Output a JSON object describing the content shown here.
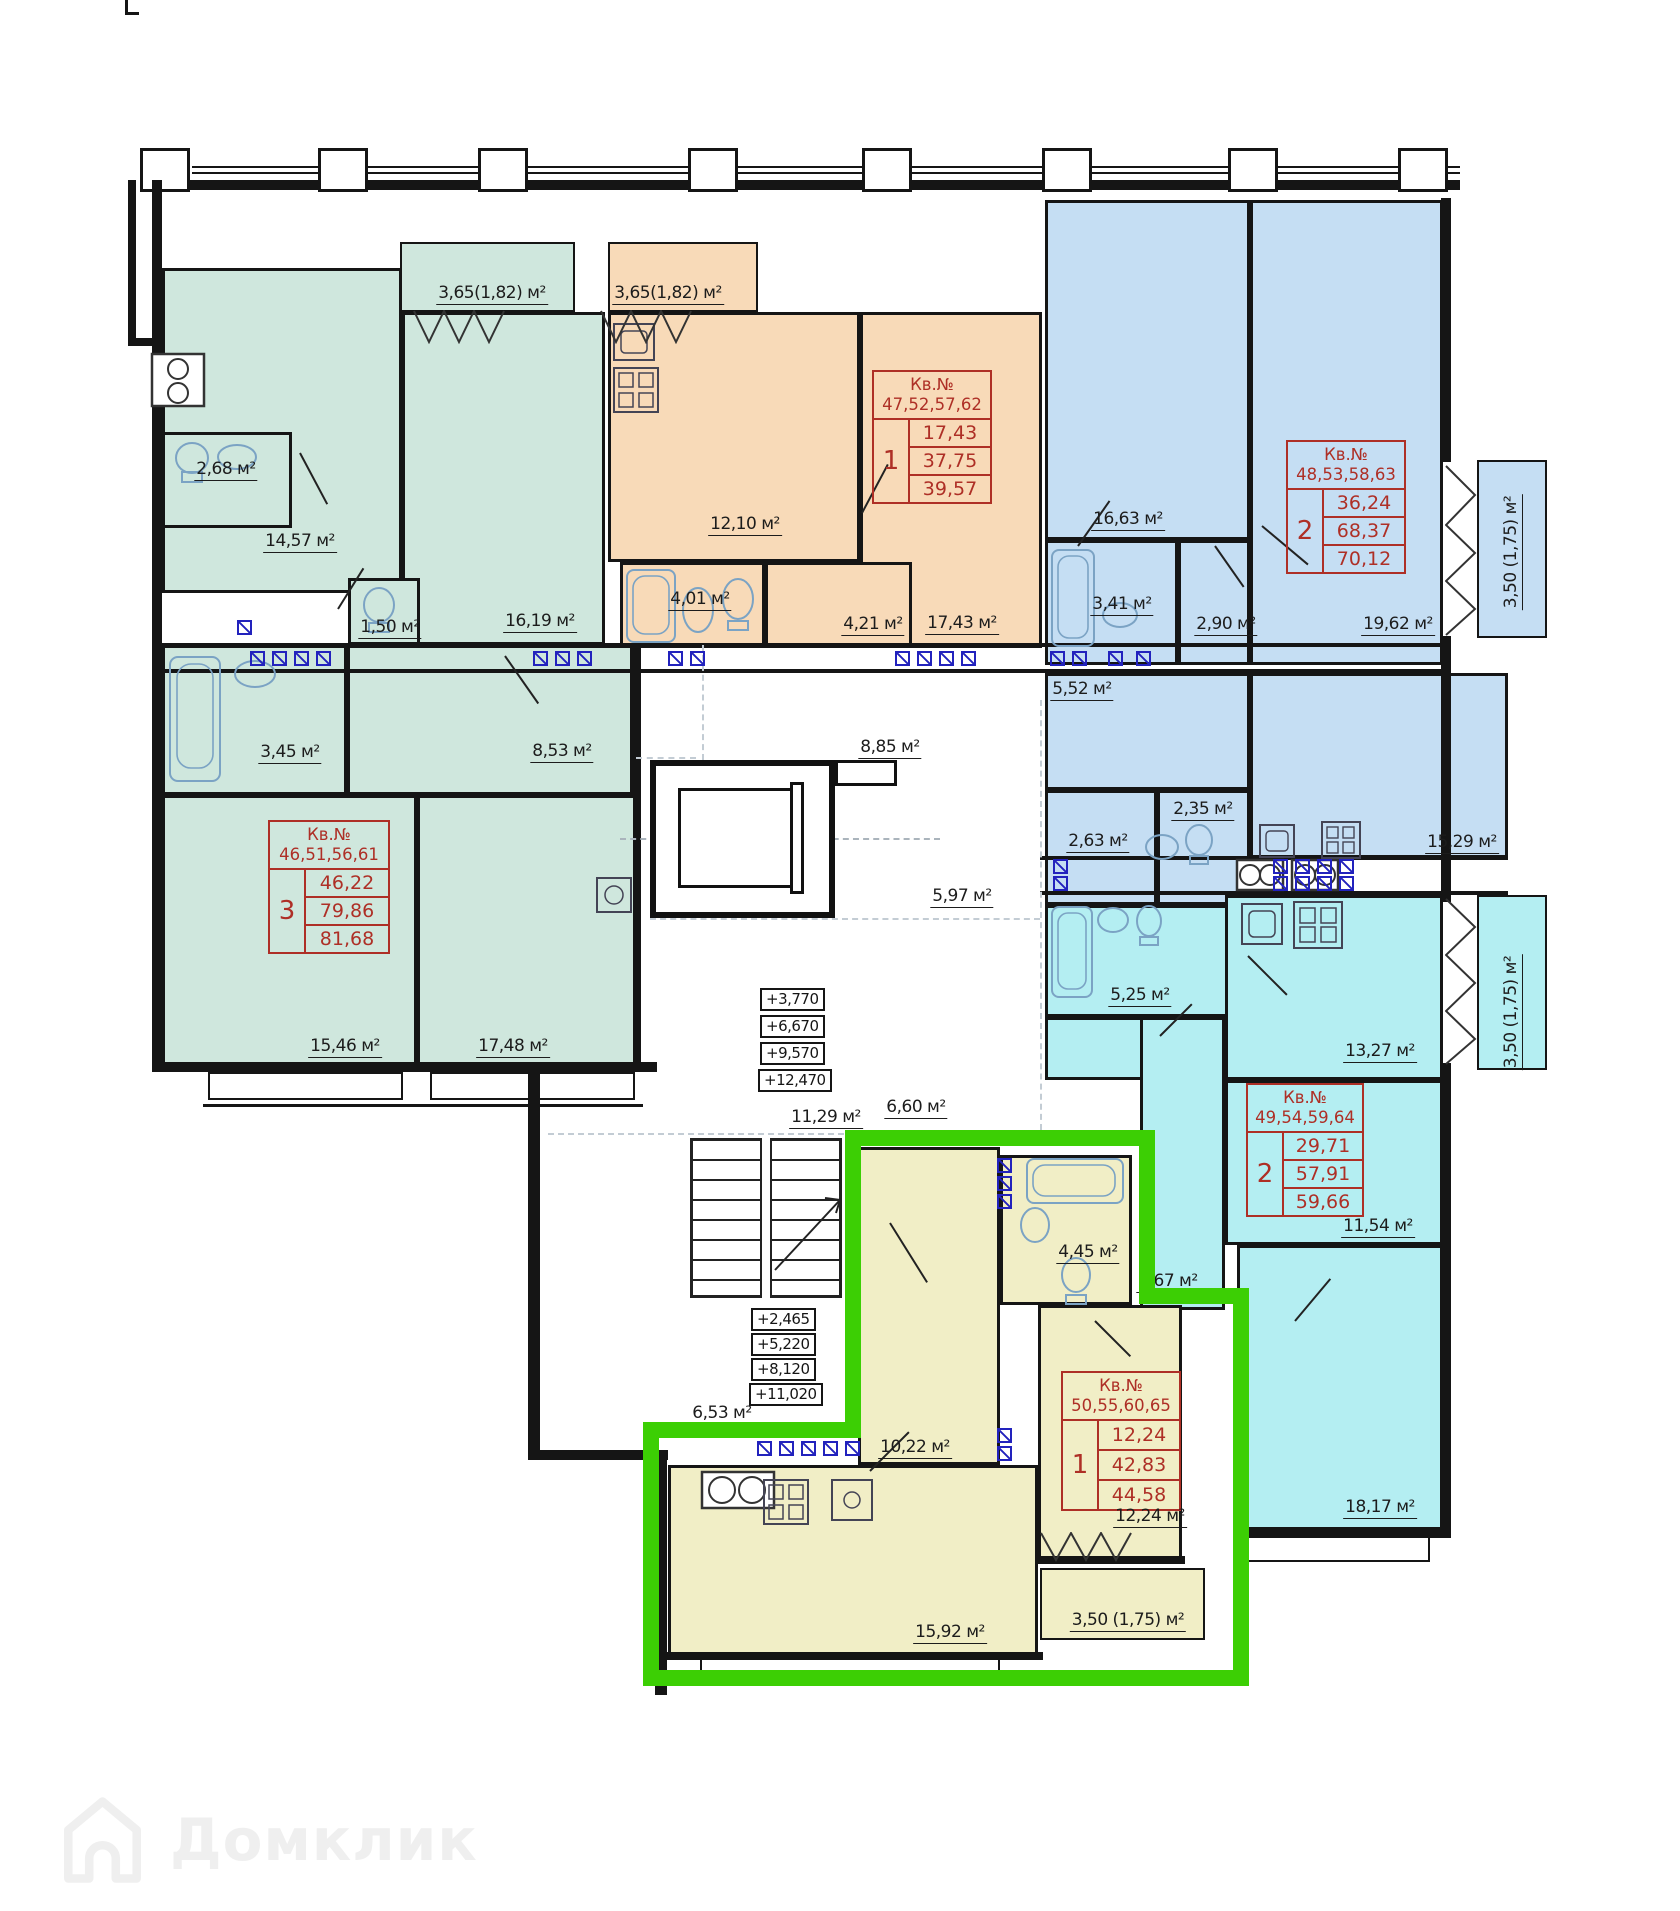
{
  "watermark": {
    "label": "Домклик",
    "icon": "domclick-house-icon"
  },
  "tables": {
    "green": {
      "kv": "Кв.№",
      "nums": "46,51,56,61",
      "rooms": "3",
      "v1": "46,22",
      "v2": "79,86",
      "v3": "81,68"
    },
    "orange": {
      "kv": "Кв.№",
      "nums": "47,52,57,62",
      "rooms": "1",
      "v1": "17,43",
      "v2": "37,75",
      "v3": "39,57"
    },
    "blue": {
      "kv": "Кв.№",
      "nums": "48,53,58,63",
      "rooms": "2",
      "v1": "36,24",
      "v2": "68,37",
      "v3": "70,12"
    },
    "cyan": {
      "kv": "Кв.№",
      "nums": "49,54,59,64",
      "rooms": "2",
      "v1": "29,71",
      "v2": "57,91",
      "v3": "59,66"
    },
    "yellow": {
      "kv": "Кв.№",
      "nums": "50,55,60,65",
      "rooms": "1",
      "v1": "12,24",
      "v2": "42,83",
      "v3": "44,58"
    }
  },
  "labels": {
    "g_balcony": "3,65(1,82) м²",
    "o_balcony": "3,65(1,82) м²",
    "g_14_57": "14,57 м²",
    "g_2_68": "2,68 м²",
    "g_1_50": "1,50 м²",
    "g_16_19": "16,19 м²",
    "g_3_45": "3,45 м²",
    "g_8_53": "8,53 м²",
    "g_15_46": "15,46 м²",
    "g_17_48": "17,48 м²",
    "o_12_10": "12,10 м²",
    "o_4_01": "4,01 м²",
    "o_4_21": "4,21 м²",
    "o_17_43": "17,43 м²",
    "b_16_63": "16,63 м²",
    "b_3_41": "3,41 м²",
    "b_2_90": "2,90 м²",
    "b_19_62": "19,62 м²",
    "b_5_52": "5,52 м²",
    "b_2_63": "2,63 м²",
    "b_2_35": "2,35 м²",
    "b_15_29": "15,29 м²",
    "b_balcony": "3,50 (1,75) м²",
    "c_5_25": "5,25 м²",
    "c_13_27": "13,27 м²",
    "c_11_54": "11,54 м²",
    "c_9_67": "9,67 м²",
    "c_18_17": "18,17 м²",
    "c_balcony": "3,50 (1,75) м²",
    "y_10_22": "10,22 м²",
    "y_4_45": "4,45 м²",
    "y_12_24": "12,24 м²",
    "y_15_92": "15,92 м²",
    "y_balcony": "3,50 (1,75) м²",
    "hall_8_85": "8,85 м²",
    "hall_5_97": "5,97 м²",
    "hall_6_60": "6,60 м²",
    "hall_11_29": "11,29 м²",
    "hall_6_53": "6,53 м²"
  },
  "elevations": {
    "upper": [
      "+3,770",
      "+6,670",
      "+9,570",
      "+12,470"
    ],
    "lower": [
      "+2,465",
      "+5,220",
      "+8,120",
      "+11,020"
    ]
  },
  "colors": {
    "highlight_outline": "#3ccf04",
    "apartment_mint": "#cfe7dd",
    "apartment_orange": "#f8dab8",
    "apartment_blue": "#c5def3",
    "apartment_cyan": "#b4eef2",
    "apartment_yellow": "#f1eec6",
    "table_red": "#ae2f26",
    "vent_blue": "#2222bd"
  }
}
